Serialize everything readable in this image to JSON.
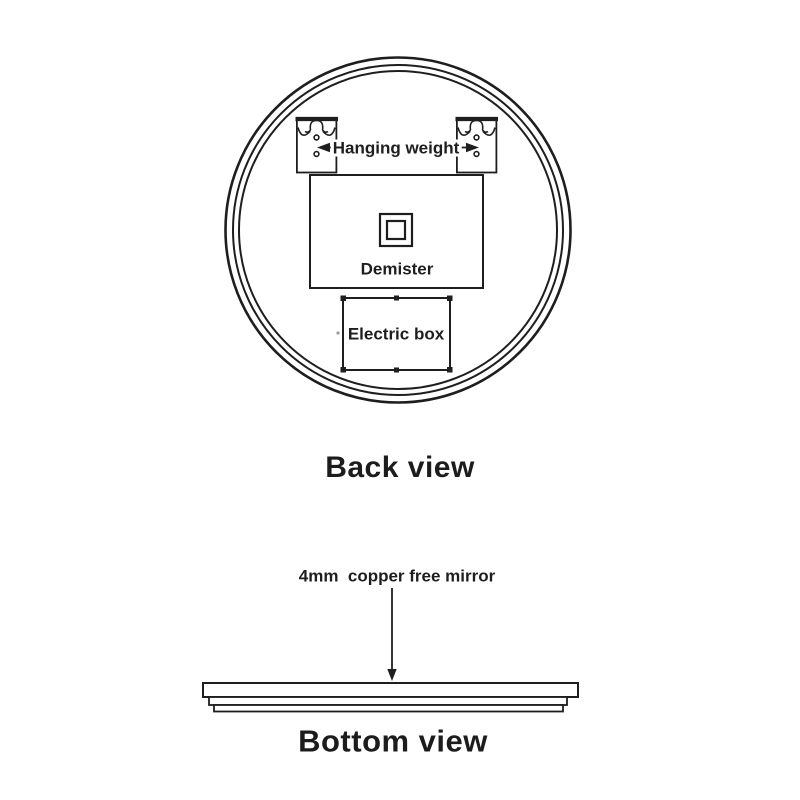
{
  "diagram": {
    "back_view": {
      "title": "Back view",
      "hanging_weight_label": "Hanging weight",
      "demister_label": "Demister",
      "electric_box_label": "Electric box"
    },
    "bottom_view": {
      "title": "Bottom view",
      "annotation": "4mm  copper free mirror"
    }
  },
  "colors": {
    "line": "#1e1e1e",
    "text": "#1e1e1e",
    "background": "#ffffff"
  }
}
